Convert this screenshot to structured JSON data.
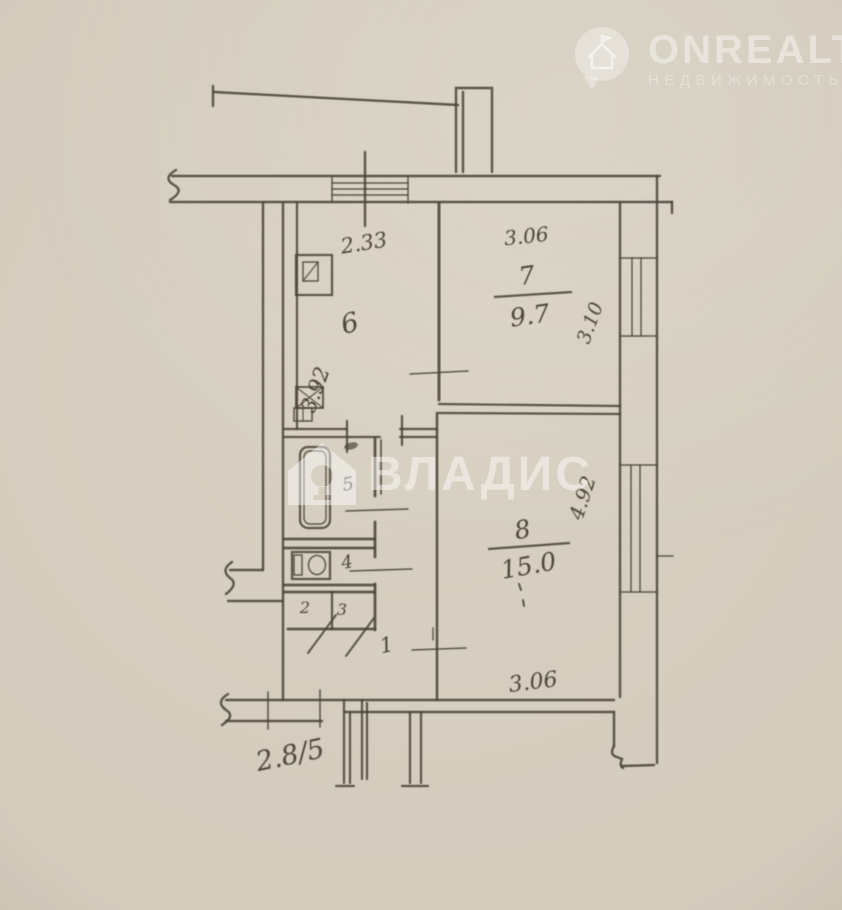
{
  "watermarks": {
    "onrealt": {
      "brand": "ONREALT",
      "subtitle": "НЕДВИЖИМОСТЬ"
    },
    "vladis": {
      "brand": "ВЛАДИС"
    }
  },
  "plan": {
    "rooms": {
      "kitchen": {
        "number": "6",
        "width": "2.33",
        "depth": "3.92"
      },
      "room7": {
        "number": "7",
        "area": "9.7",
        "width": "3.06",
        "depth": "3.10"
      },
      "room8": {
        "number": "8",
        "area": "15.0",
        "width": "3.06",
        "depth": "4.92"
      },
      "bathroom": {
        "number": "5"
      },
      "toilet": {
        "number": "4"
      },
      "closet_a": {
        "number": "2"
      },
      "closet_b": {
        "number": "3"
      },
      "hallway": {
        "number": "1"
      }
    },
    "entry_dimension": "2.8/5"
  },
  "colors": {
    "paper": "#d5cec0",
    "ink": "#4c443a",
    "watermark": "#ffffff"
  }
}
